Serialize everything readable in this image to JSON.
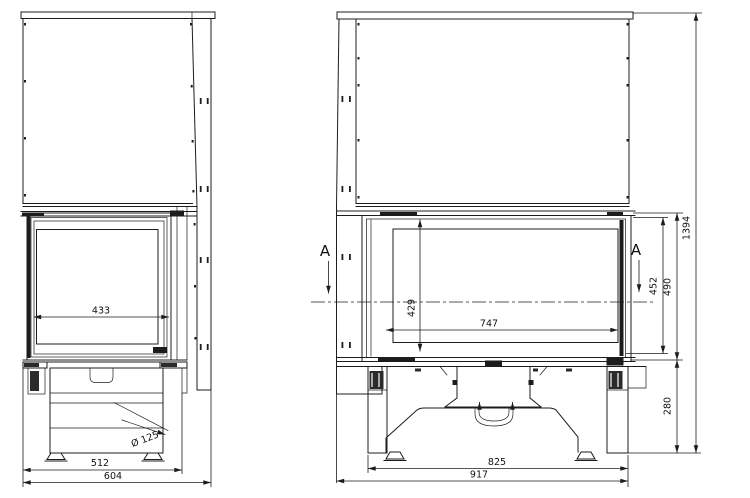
{
  "figure": {
    "kind": "technical-drawing",
    "subject": "fireplace insert dimensional drawing, side view and front view",
    "background": "#ffffff",
    "line_color": "#1c1c1c"
  },
  "side_view": {
    "dims": {
      "glass_width": "433",
      "base_depth": "512",
      "overall_depth": "604",
      "flue_diameter": "Ø 125"
    }
  },
  "front_view": {
    "section_label": "A",
    "dims": {
      "glass_width": "747",
      "glass_height": "429",
      "opening_height": "452",
      "door_height": "490",
      "overall_height": "1394",
      "plinth_height": "280",
      "body_width": "825",
      "overall_width": "917"
    }
  }
}
